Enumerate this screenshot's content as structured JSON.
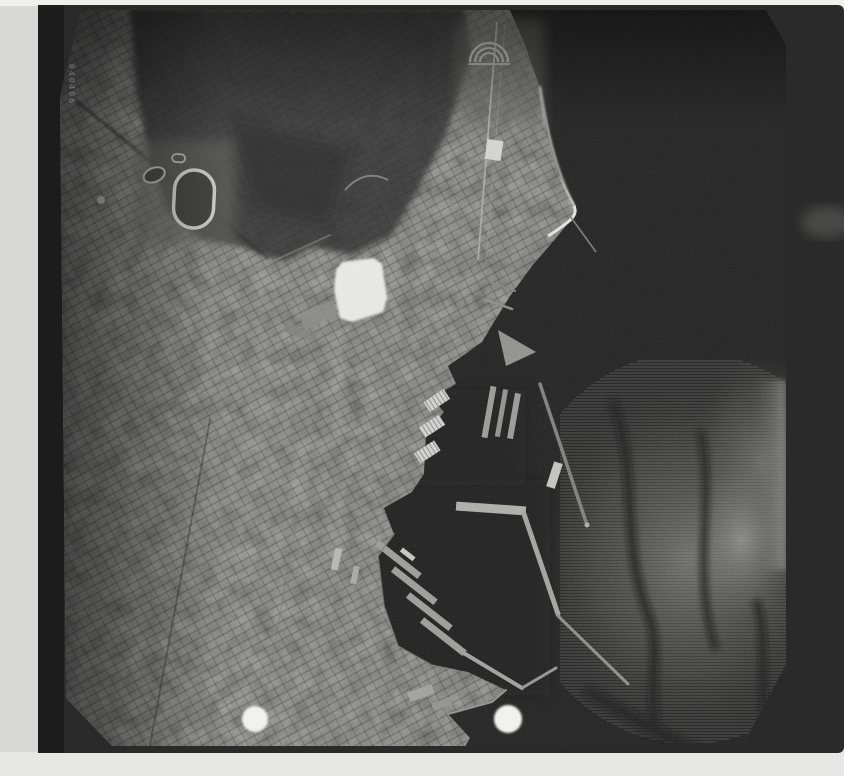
{
  "meta": {
    "canvas": {
      "width": 844,
      "height": 776
    }
  },
  "photo": {
    "kind": "black-and-white vertical aerial photograph (scanned film frame)",
    "subject": "coastal city with dense street grid, dark sea at right, harbor piers, moles and breakwaters",
    "film_edge_code": "040406",
    "regions": [
      {
        "name": "city",
        "desc": "dense urban block grid, lower left quadrant"
      },
      {
        "name": "hills",
        "desc": "dark vegetated hills and scrub, upper left"
      },
      {
        "name": "sea",
        "desc": "dark open water with sun-glint streaks, right half"
      },
      {
        "name": "harbor",
        "desc": "finger piers, L-shaped mole, slanted quays, long breakwaters"
      },
      {
        "name": "white-clearing",
        "desc": "bright white quadrilateral open lot near photo centre"
      },
      {
        "name": "stadium-track",
        "desc": "bright oval track ring, upper left"
      },
      {
        "name": "amphitheater",
        "desc": "semicircular terraced structure on the north point"
      },
      {
        "name": "beach-spit",
        "desc": "bright hooked sand spit on northeast shore"
      }
    ],
    "marks": {
      "fiducial_left": {
        "cx": 255,
        "cy": 719,
        "r": 13
      },
      "fiducial_right": {
        "cx": 508,
        "cy": 719,
        "r": 14
      },
      "edge_smudge": {
        "cx": 827,
        "cy": 222
      }
    },
    "colors": {
      "page_background": "#d8d8d6",
      "top_strip": "#f0f0ee",
      "bottom_strip": "#e8e8e6",
      "film_rebate": "#2a2a2a",
      "left_rebate": "#1c1c1c",
      "sea": "#101010",
      "glint": "#6f6f6d",
      "city_base": "#4c4c4a",
      "vegetation": "#1f1f1d",
      "highlight_white": "#f1f1ef",
      "pier_bright": "#aeaeac",
      "edge_code_text": "#8a8a8a"
    }
  }
}
